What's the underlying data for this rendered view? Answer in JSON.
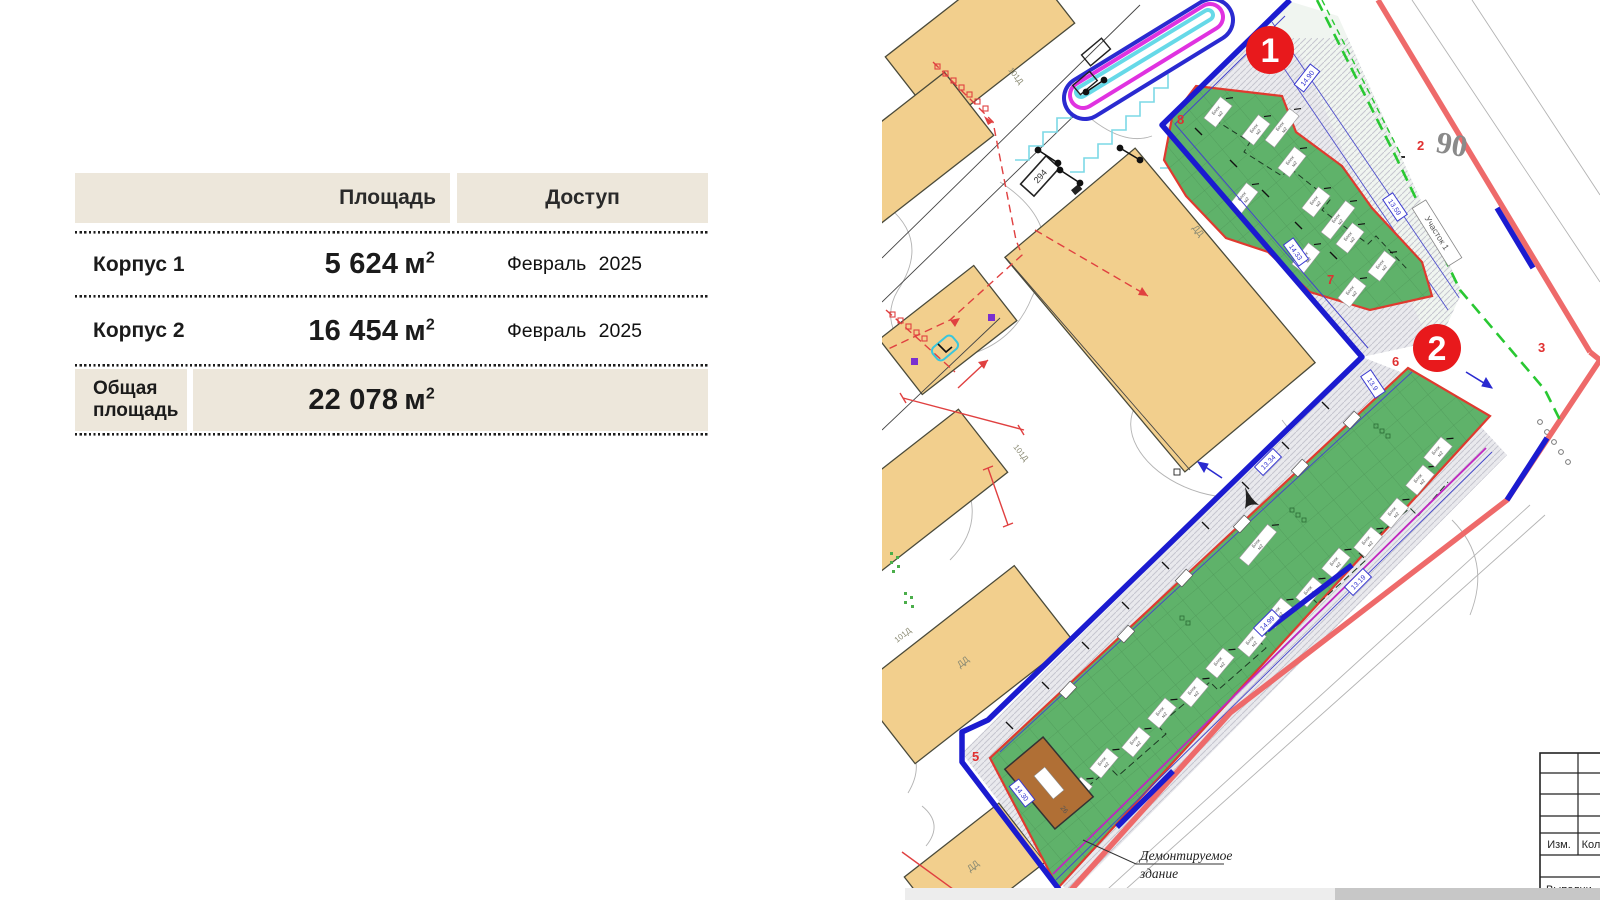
{
  "table": {
    "header": {
      "col_area": "Площадь",
      "col_access": "Доступ"
    },
    "rows": [
      {
        "name": "Корпус 1",
        "area": "5 624",
        "unit": "м",
        "sup": "2",
        "access": "Февраль 2025"
      },
      {
        "name": "Корпус 2",
        "area": "16 454",
        "unit": "м",
        "sup": "2",
        "access": "Февраль 2025"
      },
      {
        "name": "Общая площадь",
        "area": "22 078",
        "unit": "м",
        "sup": "2",
        "access": ""
      }
    ]
  },
  "map": {
    "marker_1": "1",
    "marker_2": "2",
    "street_number": "90",
    "parcel_label": "Участок 1",
    "demolished_line1": "Демонтируемое",
    "demolished_line2": "здание",
    "lot_label": "101Д",
    "dd_label": "ДД",
    "box_294": "294",
    "block_label_line1": "Блок",
    "block_label_line2": "м2",
    "title_block": {
      "izm": "Изм.",
      "kol": "Кол",
      "vypoln": "Выполни"
    },
    "corner_labels": [
      {
        "t": "8",
        "x": 1177,
        "y": 124
      },
      {
        "t": "7",
        "x": 1327,
        "y": 284
      },
      {
        "t": "6",
        "x": 1392,
        "y": 366
      },
      {
        "t": "5",
        "x": 972,
        "y": 761
      },
      {
        "t": "2",
        "x": 1417,
        "y": 150
      },
      {
        "t": "3",
        "x": 1538,
        "y": 352
      }
    ],
    "dim_boxes": [
      {
        "t": "14.90",
        "x": 1307,
        "y": 78,
        "r": -52
      },
      {
        "t": "13.59",
        "x": 1395,
        "y": 207,
        "r": 56
      },
      {
        "t": "14.33",
        "x": 1296,
        "y": 252,
        "r": 54
      },
      {
        "t": "13.9",
        "x": 1373,
        "y": 384,
        "r": 56
      },
      {
        "t": "14.30",
        "x": 1022,
        "y": 793,
        "r": 52
      },
      {
        "t": "13.34",
        "x": 1268,
        "y": 462,
        "r": -45
      },
      {
        "t": "13.19",
        "x": 1358,
        "y": 582,
        "r": -45
      },
      {
        "t": "14.99",
        "x": 1267,
        "y": 623,
        "r": -45
      }
    ],
    "blocks_k1": [
      [
        1218,
        112
      ],
      [
        1256,
        130
      ],
      [
        1292,
        162
      ],
      [
        1244,
        198
      ],
      [
        1316,
        202
      ],
      [
        1350,
        238
      ],
      [
        1306,
        258
      ],
      [
        1382,
        266
      ],
      [
        1352,
        292
      ]
    ],
    "blocks_k1_long": [
      [
        1282,
        128
      ],
      [
        1338,
        220
      ]
    ],
    "blocks_k2": [
      [
        1078,
        792
      ],
      [
        1104,
        763
      ],
      [
        1136,
        742
      ],
      [
        1162,
        713
      ],
      [
        1194,
        692
      ],
      [
        1220,
        663
      ],
      [
        1252,
        642
      ],
      [
        1278,
        613
      ],
      [
        1310,
        592
      ],
      [
        1336,
        563
      ],
      [
        1368,
        542
      ],
      [
        1394,
        513
      ],
      [
        1420,
        480
      ],
      [
        1438,
        452
      ]
    ],
    "blocks_k2_long": [
      [
        1258,
        545
      ]
    ],
    "road_boxes": [
      [
        1068,
        690
      ],
      [
        1126,
        634
      ],
      [
        1184,
        578
      ],
      [
        1242,
        524
      ],
      [
        1300,
        468
      ],
      [
        1352,
        420
      ]
    ],
    "colors": {
      "boundary_blue": "#1b1bd0",
      "boundary_red": "#ee6a6a",
      "green_fill": "#5fb26a",
      "green_edge_red": "#e03a2f",
      "magenta": "#c026c0",
      "green_dashed": "#29c832",
      "tan_building": "#f2cf8d",
      "brown_building": "#b06f35",
      "marker_red": "#e8191c",
      "table_beige": "#EDE7DB"
    }
  }
}
